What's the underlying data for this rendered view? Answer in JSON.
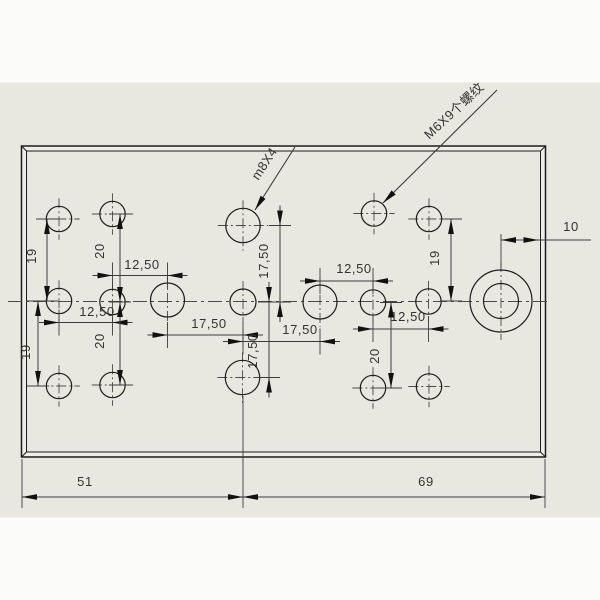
{
  "drawing": {
    "colors": {
      "page_white": "#fbfbf9",
      "canvas_gray": "#e8e8e1",
      "plate_border_fill": "#eeeee7",
      "edge_line": "#1c1c1c",
      "dim_line": "#3b3b3b",
      "center_line": "#4a4a4a",
      "text": "#333333",
      "arrow_fill": "#111111"
    },
    "canvas_band": {
      "top": 82.5,
      "bottom": 517.5
    },
    "plate": {
      "x": 21.5,
      "y": 146,
      "w": 524,
      "h": 311,
      "inset": 5
    },
    "centerline": {
      "y": 301.5,
      "x1": 8,
      "x2": 547
    },
    "holes": [
      {
        "cx": 59,
        "cy": 219,
        "r": 12.7,
        "kind": "m6-tapped-hole"
      },
      {
        "cx": 112.5,
        "cy": 214,
        "r": 12.7,
        "kind": "m6-tapped-hole"
      },
      {
        "cx": 243,
        "cy": 225.5,
        "r": 17.2,
        "kind": "m8-tapped-hole"
      },
      {
        "cx": 374,
        "cy": 213.5,
        "r": 12.7,
        "kind": "m6-tapped-hole"
      },
      {
        "cx": 429,
        "cy": 219,
        "r": 12.7,
        "kind": "m6-tapped-hole"
      },
      {
        "cx": 59,
        "cy": 301,
        "r": 12.7,
        "kind": "m6-tapped-hole"
      },
      {
        "cx": 112.5,
        "cy": 302,
        "r": 12.7,
        "kind": "m6-tapped-hole"
      },
      {
        "cx": 167.5,
        "cy": 300,
        "r": 17.0,
        "kind": "m8-tapped-hole"
      },
      {
        "cx": 243,
        "cy": 302,
        "r": 13.0,
        "kind": "m6-tapped-hole"
      },
      {
        "cx": 320,
        "cy": 302,
        "r": 17.0,
        "kind": "m8-tapped-hole"
      },
      {
        "cx": 373,
        "cy": 302.5,
        "r": 12.7,
        "kind": "m6-tapped-hole"
      },
      {
        "cx": 428.5,
        "cy": 301.5,
        "r": 12.7,
        "kind": "m6-tapped-hole"
      },
      {
        "cx": 501,
        "cy": 301,
        "r": 31,
        "r2": 17.5,
        "kind": "counterbore-hole"
      },
      {
        "cx": 59,
        "cy": 386,
        "r": 12.7,
        "kind": "m6-tapped-hole"
      },
      {
        "cx": 112.5,
        "cy": 385,
        "r": 12.7,
        "kind": "m6-tapped-hole"
      },
      {
        "cx": 242.5,
        "cy": 377.5,
        "r": 17.2,
        "kind": "m8-tapped-hole"
      },
      {
        "cx": 373,
        "cy": 388,
        "r": 12.7,
        "kind": "m6-tapped-hole"
      },
      {
        "cx": 429,
        "cy": 386.5,
        "r": 12.7,
        "kind": "m6-tapped-hole"
      }
    ],
    "dims": [
      {
        "orient": "h",
        "text": "12,50",
        "a": 112.5,
        "b": 167.5,
        "line": 275.5,
        "tx": 142,
        "ty": 269,
        "style": "outside"
      },
      {
        "orient": "h",
        "text": "12,50",
        "a": 59,
        "b": 112.5,
        "line": 322.5,
        "tx": 97,
        "ty": 316,
        "style": "outside"
      },
      {
        "orient": "h",
        "text": "17,50",
        "a": 167.5,
        "b": 243,
        "line": 335,
        "tx": 209,
        "ty": 328,
        "style": "outside"
      },
      {
        "orient": "h",
        "text": "17,50",
        "a": 243,
        "b": 320,
        "line": 341.5,
        "tx": 300,
        "ty": 334,
        "style": "outside"
      },
      {
        "orient": "h",
        "text": "12,50",
        "a": 320,
        "b": 373,
        "line": 281,
        "tx": 354,
        "ty": 273,
        "style": "outside"
      },
      {
        "orient": "h",
        "text": "12,50",
        "a": 373,
        "b": 428.5,
        "line": 329,
        "tx": 408,
        "ty": 321,
        "style": "outside"
      },
      {
        "orient": "v",
        "text": "19",
        "a": 219,
        "b": 301,
        "line": 47,
        "tx": 36,
        "ty": 256,
        "style": "inside"
      },
      {
        "orient": "v",
        "text": "20",
        "a": 214,
        "b": 302,
        "line": 120,
        "tx": 104,
        "ty": 251,
        "style": "inside"
      },
      {
        "orient": "v",
        "text": "19",
        "a": 301,
        "b": 386,
        "line": 38,
        "tx": 30,
        "ty": 352,
        "style": "inside"
      },
      {
        "orient": "v",
        "text": "20",
        "a": 302,
        "b": 385,
        "line": 120,
        "tx": 104,
        "ty": 341,
        "style": "inside"
      },
      {
        "orient": "v",
        "text": "19",
        "a": 219,
        "b": 301,
        "line": 451,
        "tx": 439,
        "ty": 258,
        "style": "inside"
      },
      {
        "orient": "v",
        "text": "20",
        "a": 302.5,
        "b": 388,
        "line": 391,
        "tx": 379,
        "ty": 356,
        "style": "inside"
      },
      {
        "orient": "v",
        "text": "17,50",
        "a": 225.5,
        "b": 302,
        "line": 280,
        "tx": 268,
        "ty": 261,
        "style": "outside"
      },
      {
        "orient": "v",
        "text": "17,50",
        "a": 302,
        "b": 377.5,
        "line": 269,
        "tx": 257,
        "ty": 351,
        "style": "outside"
      },
      {
        "orient": "h",
        "text": "10",
        "a": 501,
        "b": 538.5,
        "line": 240,
        "tx": 571,
        "ty": 231,
        "style": "inside",
        "tail": 591,
        "noticks": true
      },
      {
        "orient": "h",
        "text": "51",
        "a": 22,
        "b": 243,
        "line": 497,
        "tx": 85,
        "ty": 486,
        "style": "inside",
        "noticks": true
      },
      {
        "orient": "h",
        "text": "69",
        "a": 243,
        "b": 545,
        "line": 497,
        "tx": 426,
        "ty": 486,
        "style": "inside",
        "noticks": true
      }
    ],
    "ext_lines": [
      {
        "x1": 22,
        "y1": 459,
        "x2": 22,
        "y2": 508
      },
      {
        "x1": 243,
        "y1": 396,
        "x2": 243,
        "y2": 508
      },
      {
        "x1": 545,
        "y1": 459,
        "x2": 545,
        "y2": 508
      },
      {
        "x1": 501,
        "y1": 234,
        "x2": 501,
        "y2": 268
      }
    ],
    "leaders": [
      {
        "text": "m8X4",
        "x1": 255,
        "y1": 210,
        "x2": 295,
        "y2": 147,
        "tx": 268,
        "ty": 166,
        "angle": -57
      },
      {
        "text": "M6X9个螺纹",
        "x1": 383,
        "y1": 203,
        "x2": 497,
        "y2": 90,
        "tx": 457,
        "ty": 114,
        "angle": -43
      }
    ]
  }
}
